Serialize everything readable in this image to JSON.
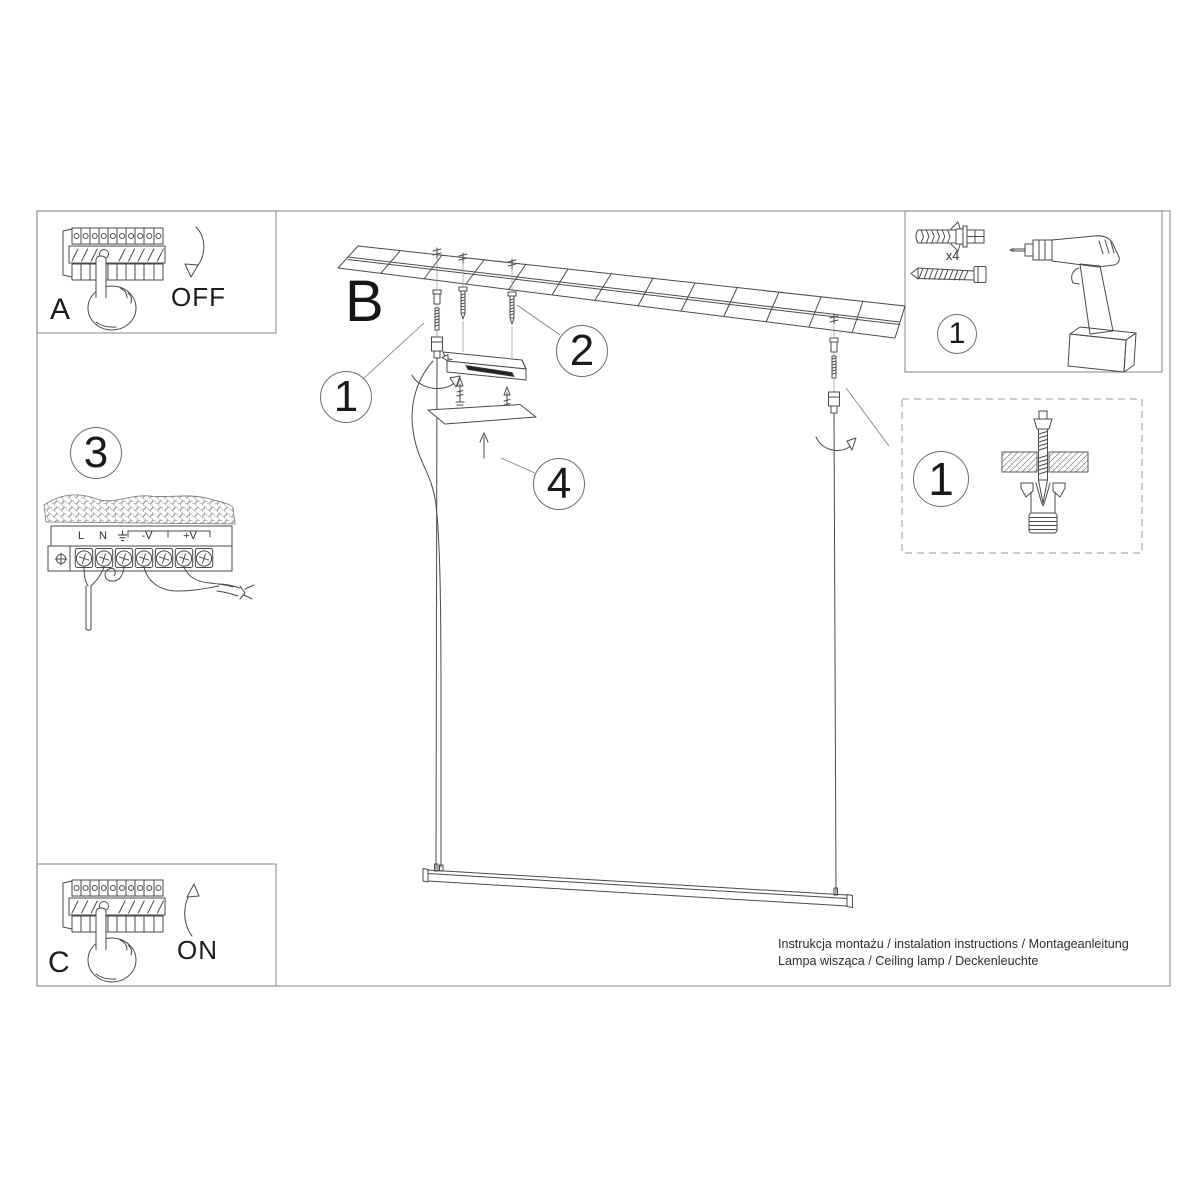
{
  "panel_a": {
    "label": "A",
    "switch_state": "OFF"
  },
  "panel_c": {
    "label": "C",
    "switch_state": "ON"
  },
  "main_view": {
    "label": "B"
  },
  "callouts": {
    "wiring_step": "3",
    "suspension_left": "1",
    "mounting_screws": "2",
    "cover_plate": "4",
    "tools": "1",
    "anchor_detail": "1"
  },
  "tools_box": {
    "anchor_quantity": "x4"
  },
  "terminal_block": {
    "labels": [
      "L",
      "N",
      "-V",
      "+V"
    ]
  },
  "footer": {
    "line1": "Instrukcja montażu / instalation instructions / Montageanleitung",
    "line2": "Lampa wisząca / Ceiling lamp / Deckenleuchte"
  },
  "colors": {
    "ink": "#4a4a4a",
    "frame": "#8f8f8f",
    "text": "#1f1f1f"
  }
}
